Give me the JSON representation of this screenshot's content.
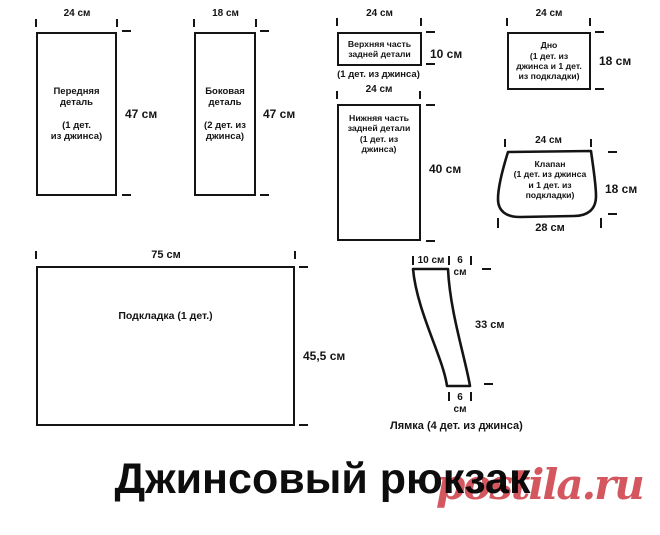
{
  "title": "Джинсовый рюкзак",
  "watermark": "postila.ru",
  "colors": {
    "line": "#141414",
    "watermark": "#d4565f"
  },
  "pieces": {
    "front": {
      "width": "24 см",
      "height": "47 см",
      "label": "Передняя\nдеталь\n\n(1 дет.\nиз джинса)"
    },
    "side": {
      "width": "18 см",
      "height": "47 см",
      "label": "Боковая\nдеталь\n\n(2 дет. из\nджинса)"
    },
    "back_top": {
      "width": "24 см",
      "height": "10 см",
      "label": "Верхняя часть\nзадней детали",
      "note": "(1 дет. из джинса)"
    },
    "bottom": {
      "width": "24 см",
      "height": "18 см",
      "label": "Дно\n(1 дет. из\nджинса и 1 дет.\nиз подкладки)"
    },
    "back_bottom": {
      "width": "24 см",
      "height": "40 см",
      "label": "Нижняя часть\nзадней детали\n(1 дет. из\nджинса)"
    },
    "flap": {
      "width_top": "24 см",
      "height": "18 см",
      "width_bottom": "28 см",
      "label": "Клапан\n(1 дет. из джинса\nи 1 дет. из\nподкладки)"
    },
    "lining": {
      "width": "75 см",
      "height": "45,5 см",
      "label": "Подкладка (1 дет.)"
    },
    "strap": {
      "width_top": "10 см",
      "side_top": "6",
      "side_top_unit": "см",
      "height": "33 см",
      "width_bottom": "6",
      "width_bottom_unit": "см",
      "caption": "Лямка (4 дет. из джинса)"
    }
  }
}
